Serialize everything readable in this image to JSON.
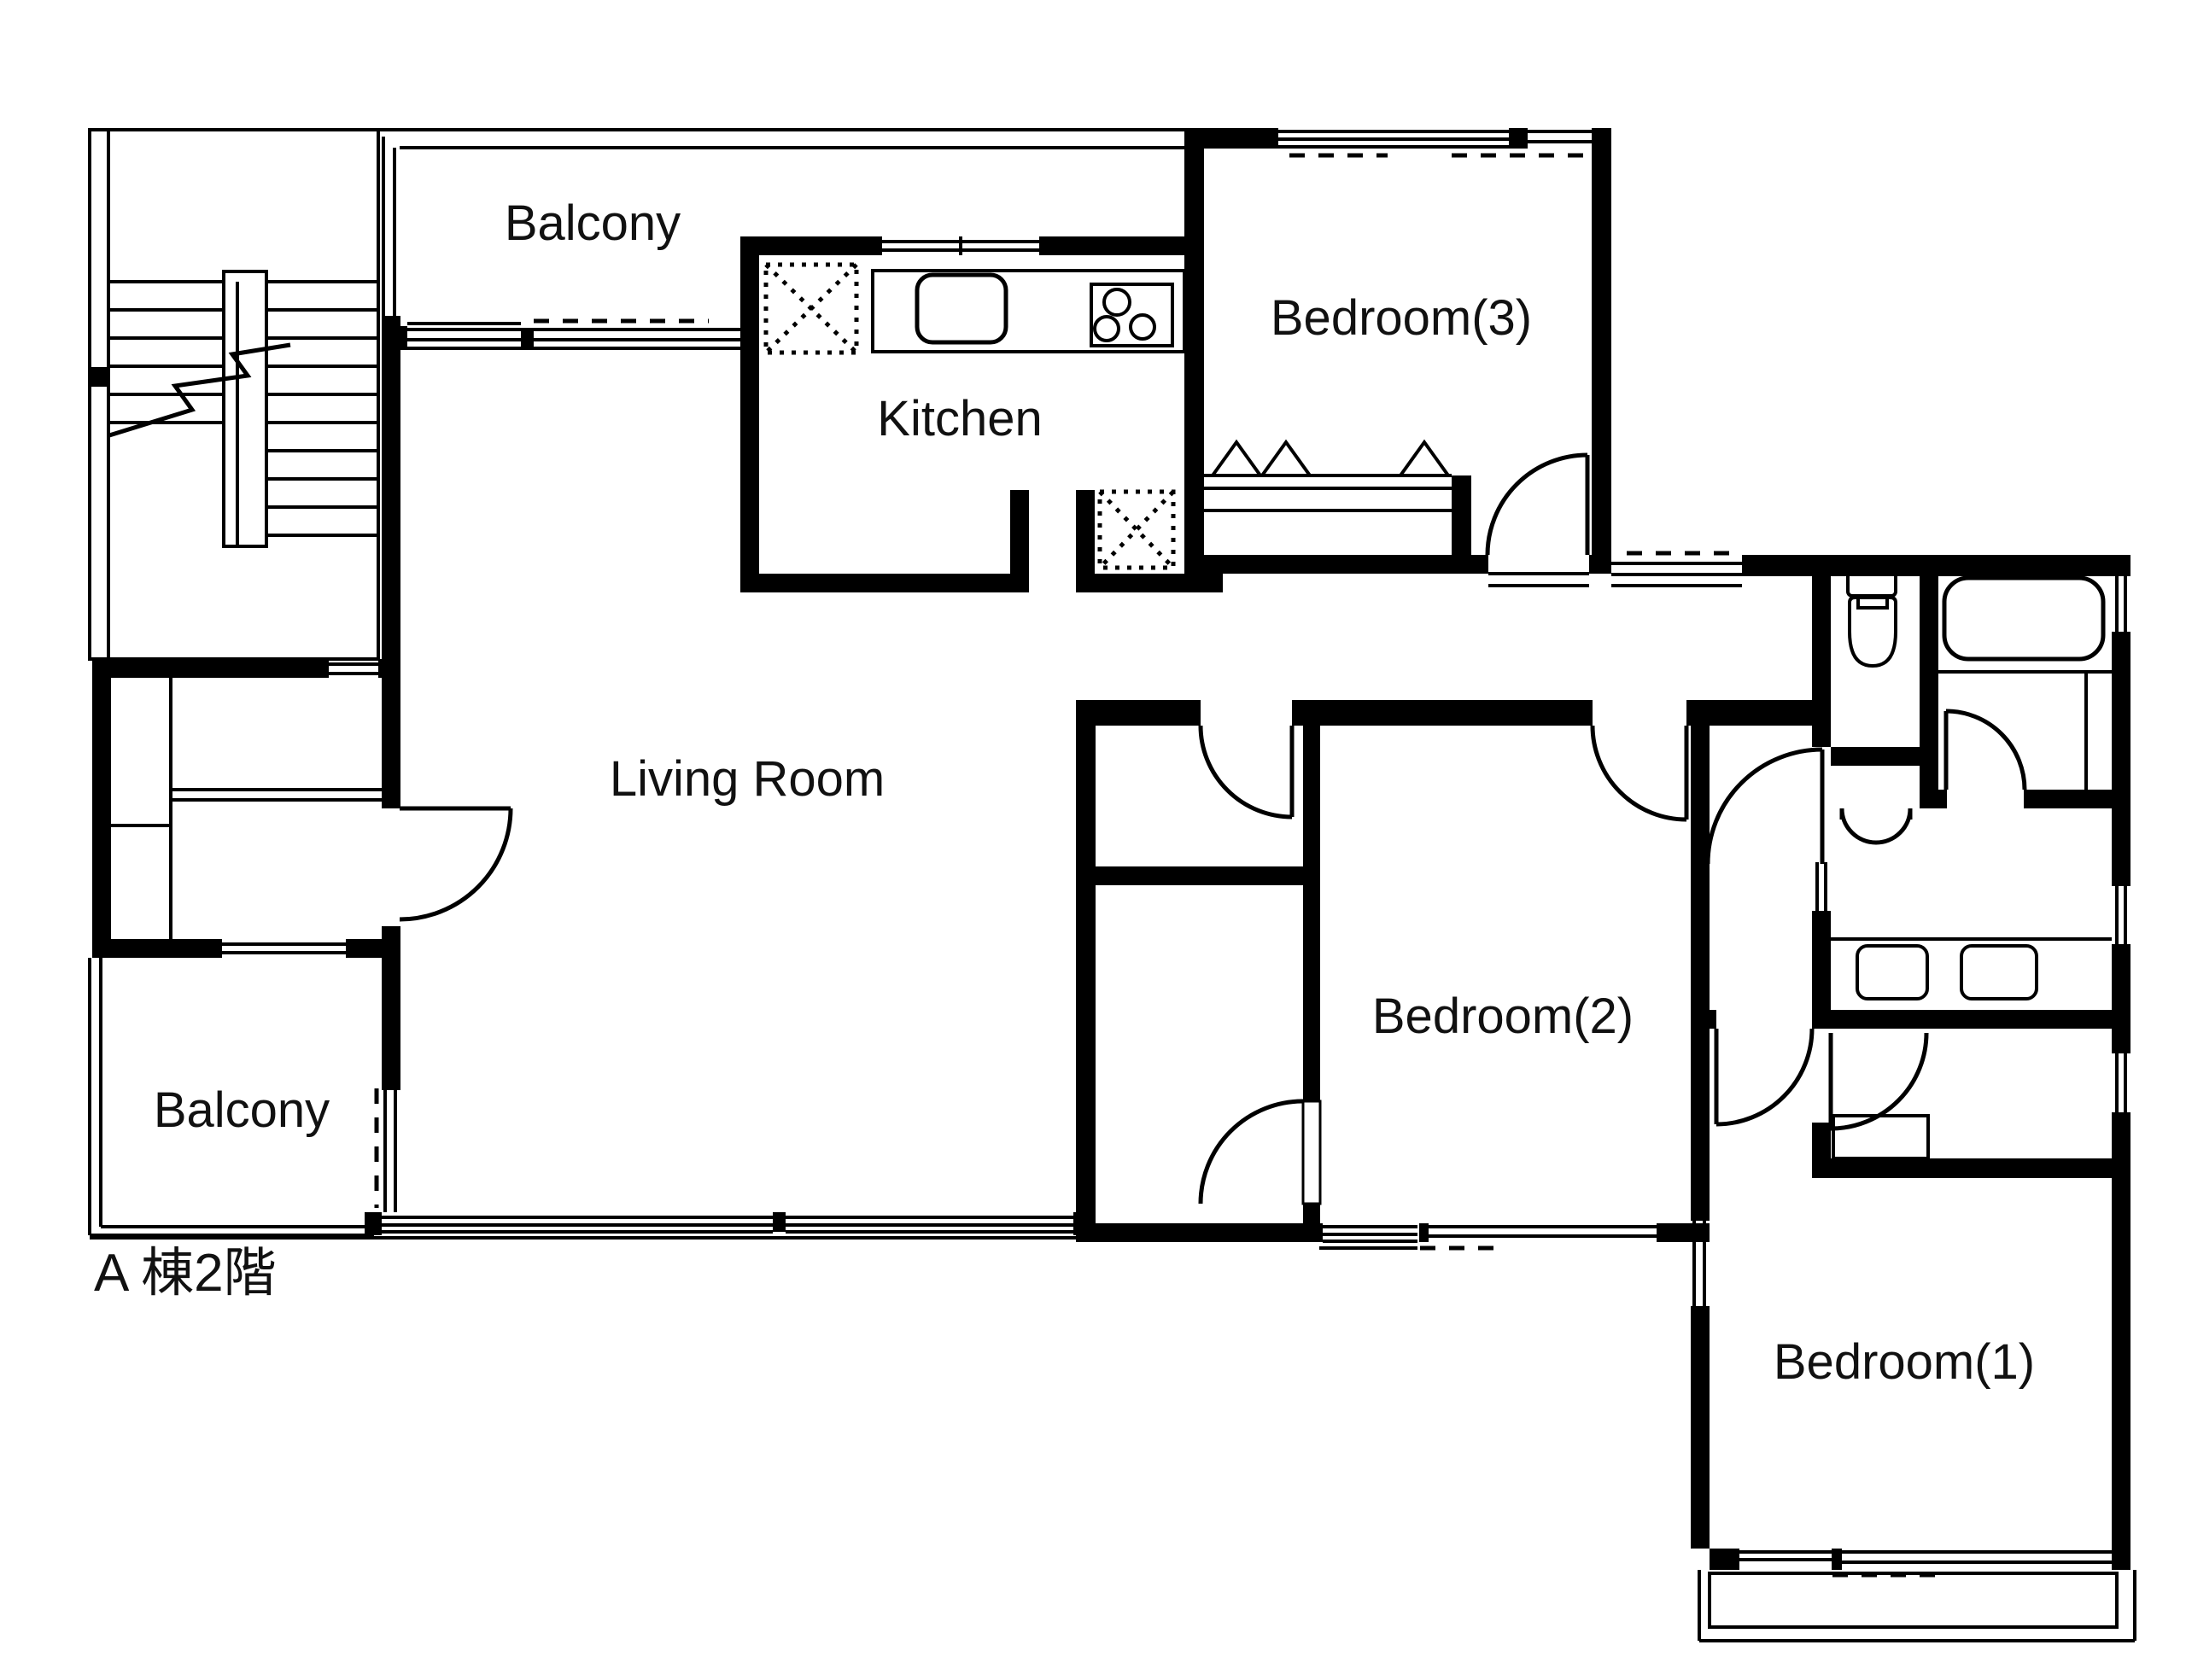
{
  "title": "A 棟2階 floor plan",
  "colors": {
    "wall": "#000000",
    "background": "#ffffff",
    "text": "#111111"
  },
  "rooms": [
    {
      "id": "balcony-top",
      "label": "Balcony"
    },
    {
      "id": "kitchen",
      "label": "Kitchen"
    },
    {
      "id": "bedroom-3",
      "label": "Bedroom(3)"
    },
    {
      "id": "living-room",
      "label": "Living Room"
    },
    {
      "id": "bedroom-2",
      "label": "Bedroom(2)"
    },
    {
      "id": "balcony-bottom",
      "label": "Balcony"
    },
    {
      "id": "bedroom-1",
      "label": "Bedroom(1)"
    }
  ],
  "floor_label": "A 棟2階",
  "fixtures": [
    "stairs",
    "refrigerator-space",
    "kitchen-counter",
    "kitchen-sink",
    "stove-3-burner",
    "laundry-space",
    "toilet",
    "bathtub",
    "washer-units",
    "closet-bedroom3",
    "closet-bedroom1"
  ]
}
